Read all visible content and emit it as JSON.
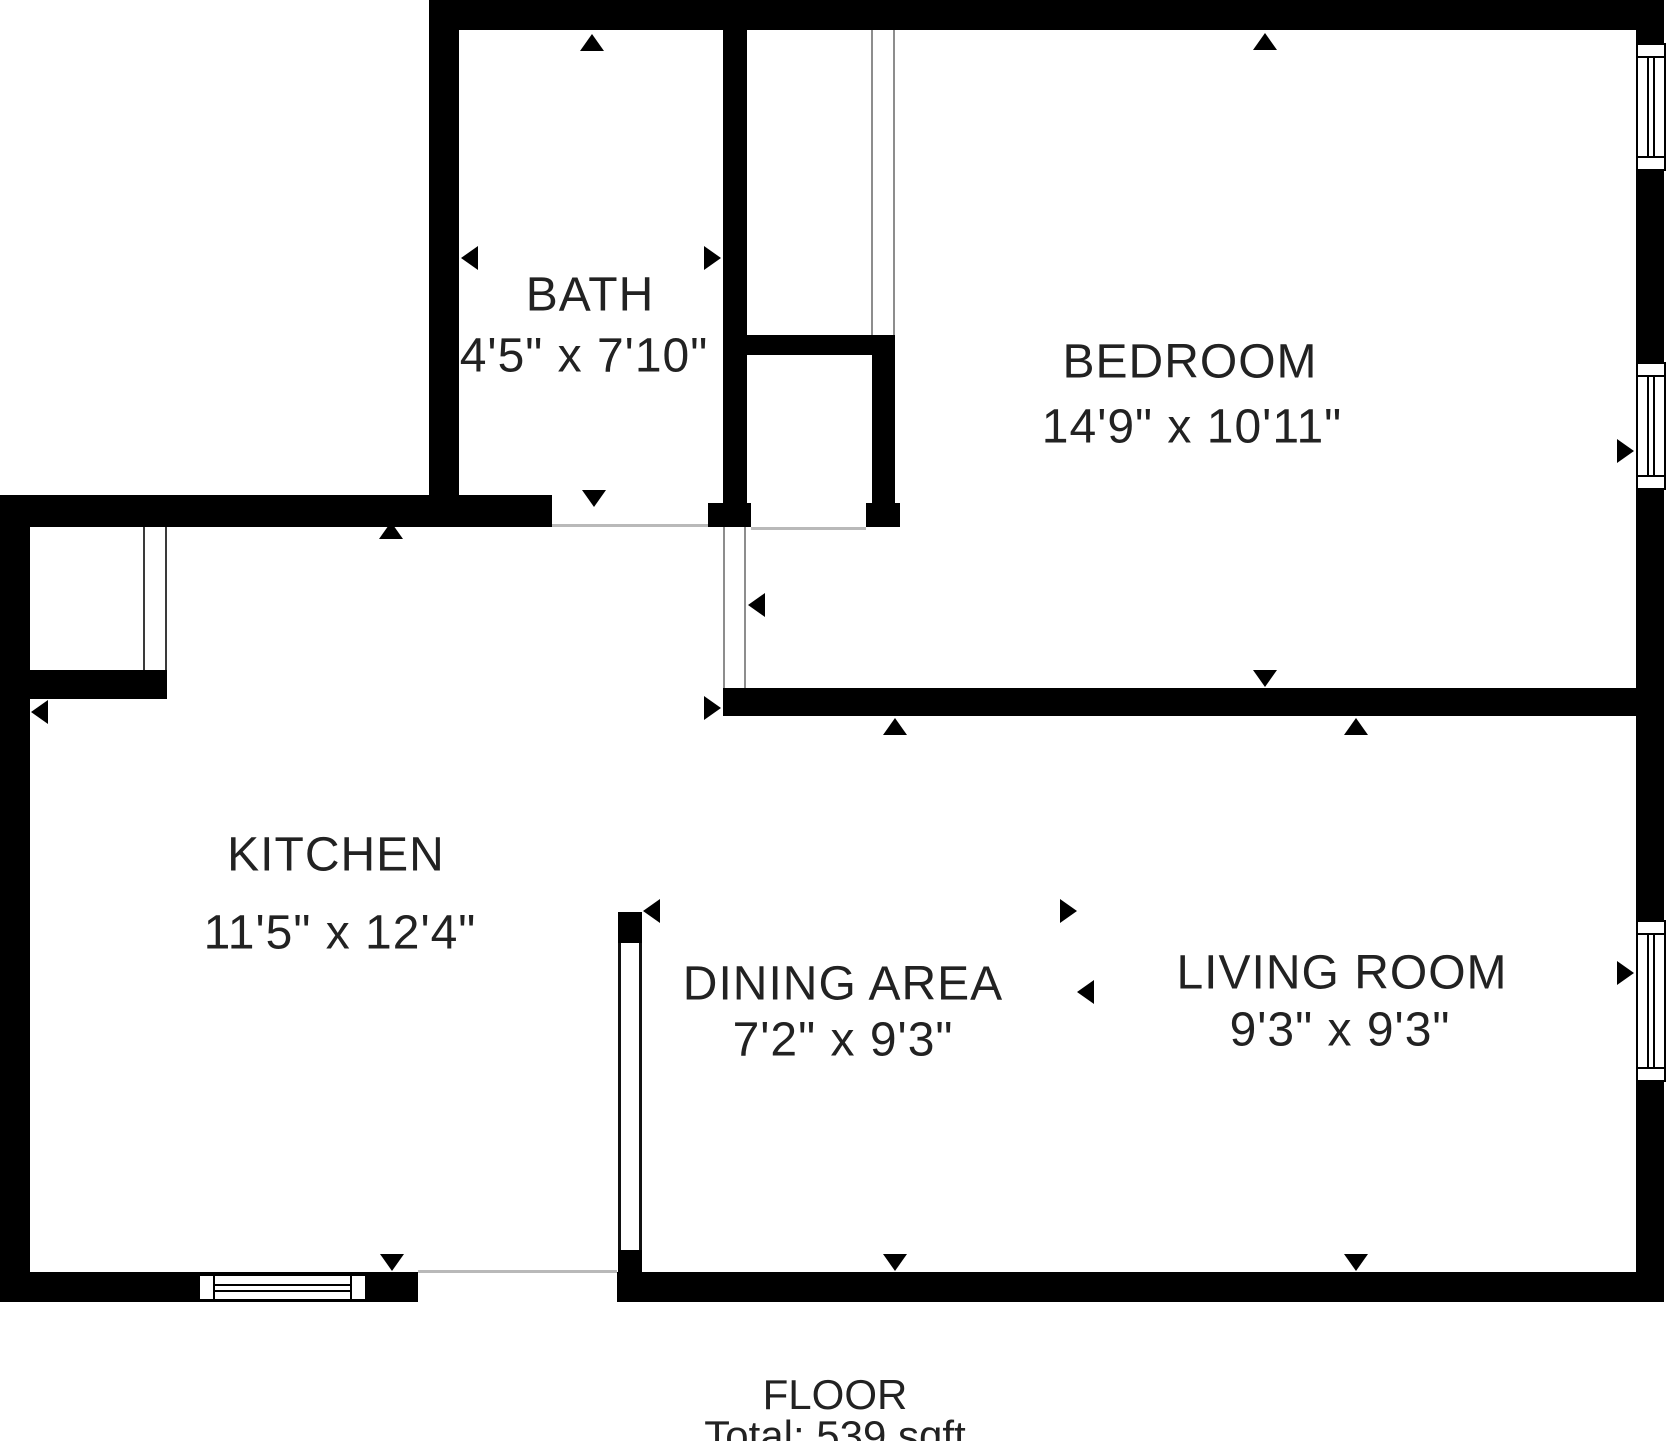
{
  "colors": {
    "wall": "#000000",
    "background": "#ffffff",
    "text": "#222222",
    "opening_line": "#b9b9b9"
  },
  "rooms": [
    {
      "id": "bath",
      "name": "BATH",
      "dimensions": "4'5\" x 7'10\""
    },
    {
      "id": "bedroom",
      "name": "BEDROOM",
      "dimensions": "14'9\" x 10'11\""
    },
    {
      "id": "kitchen",
      "name": "KITCHEN",
      "dimensions": "11'5\" x 12'4\""
    },
    {
      "id": "dining",
      "name": "DINING AREA",
      "dimensions": "7'2\" x 9'3\""
    },
    {
      "id": "living",
      "name": "LIVING ROOM",
      "dimensions": "9'3\" x 9'3\""
    }
  ],
  "summary": {
    "floor_label": "FLOOR",
    "total_label": "Total: 539 sqft"
  }
}
